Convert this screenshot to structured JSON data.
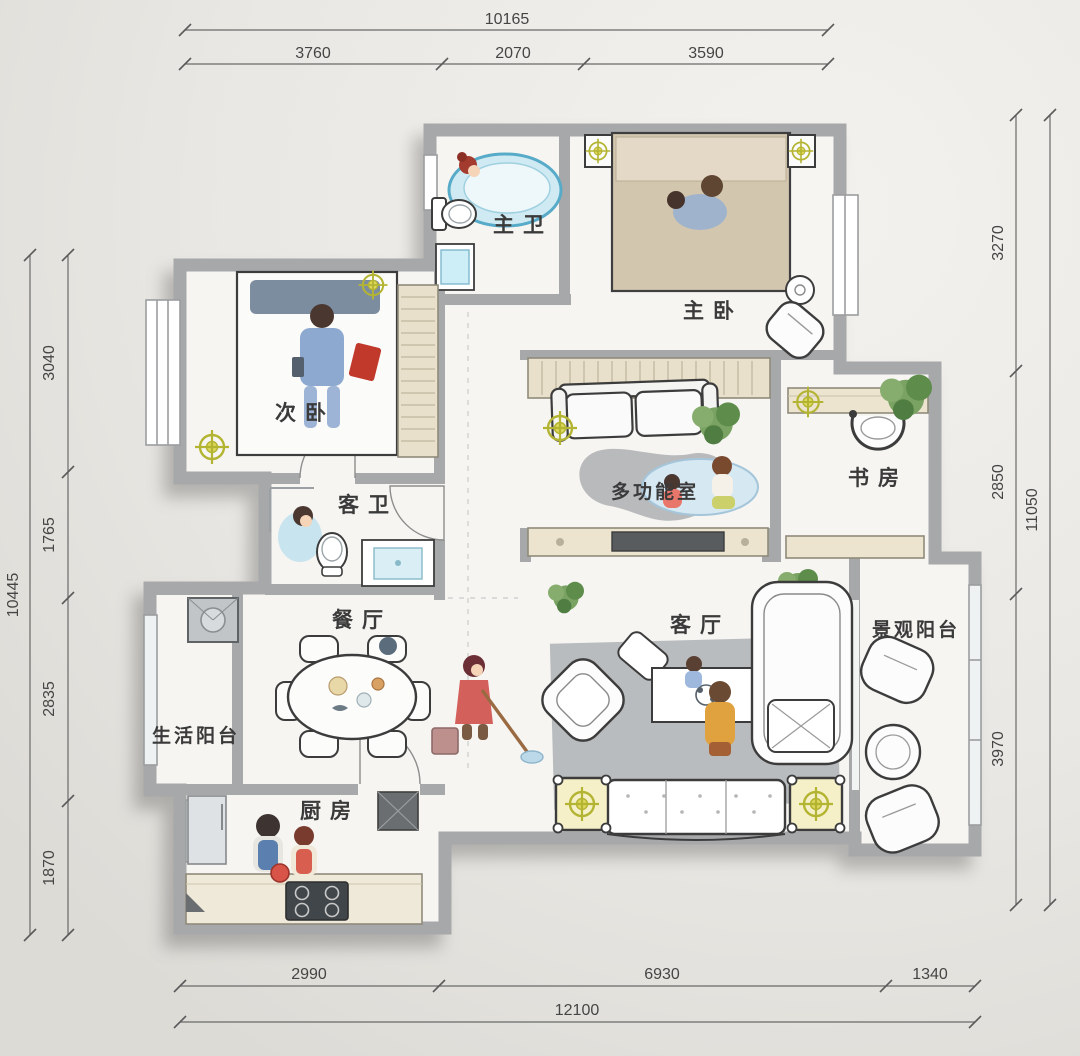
{
  "plan": {
    "rooms": {
      "master_bath": "主卫",
      "master_bedroom": "主卧",
      "second_bedroom": "次卧",
      "guest_bath": "客卫",
      "multi_function_room": "多功能室",
      "study": "书房",
      "dining_room": "餐厅",
      "living_room": "客厅",
      "view_balcony": "景观阳台",
      "utility_balcony": "生活阳台",
      "kitchen": "厨房"
    },
    "dimensions": {
      "top": {
        "total": "10165",
        "segments": [
          "3760",
          "2070",
          "3590"
        ]
      },
      "bottom": {
        "total": "12100",
        "segments": [
          "2990",
          "6930",
          "1340"
        ]
      },
      "left": {
        "total": "10445",
        "segments": [
          "3040",
          "1765",
          "2835",
          "1870"
        ]
      },
      "right": {
        "total": "11050",
        "segments": [
          "3270",
          "2850",
          "3970"
        ]
      }
    },
    "colors": {
      "background": "#e9e7e3",
      "floor": "#f6f5f2",
      "wall": "#a6a8aa",
      "cabinet_wood": "#ece4cf",
      "accent_lamp_yellow": "#ddd75a",
      "bathtub_blue": "#cfeaf2",
      "rug_gray": "#b5b8ba",
      "plant_green": "#76a05e"
    }
  }
}
